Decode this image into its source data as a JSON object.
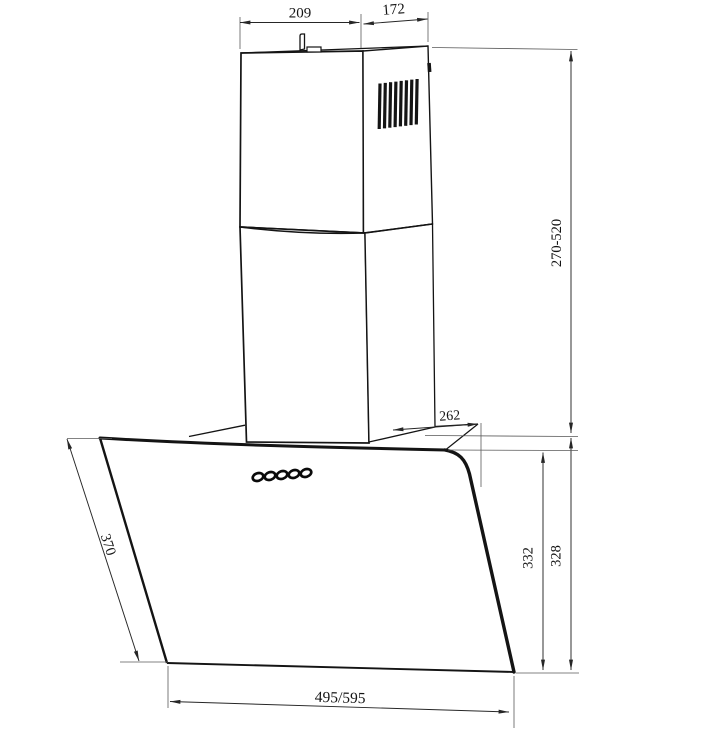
{
  "page_title": "Range Hood Dimension Drawing",
  "colors": {
    "background": "#ffffff",
    "object_line": "#141414",
    "dimension_line": "#262626",
    "extension_line": "#5a5a5a"
  },
  "dimensions": {
    "chimney_top_width": "209",
    "chimney_top_depth": "172",
    "chimney_height_range": "270-520",
    "canopy_top_depth": "262",
    "glass_panel_height": "332",
    "body_rear_height": "328",
    "glass_panel_slant_depth": "370",
    "hood_width": "495/595"
  },
  "components": {
    "chimney_upper": "chimney-upper-section",
    "chimney_lower": "chimney-lower-section",
    "vent_grille": "vent-grille",
    "mounting_bracket": "mounting-bracket",
    "control_buttons": "control-buttons",
    "glass_panel": "glass-panel",
    "canopy": "canopy-top"
  }
}
